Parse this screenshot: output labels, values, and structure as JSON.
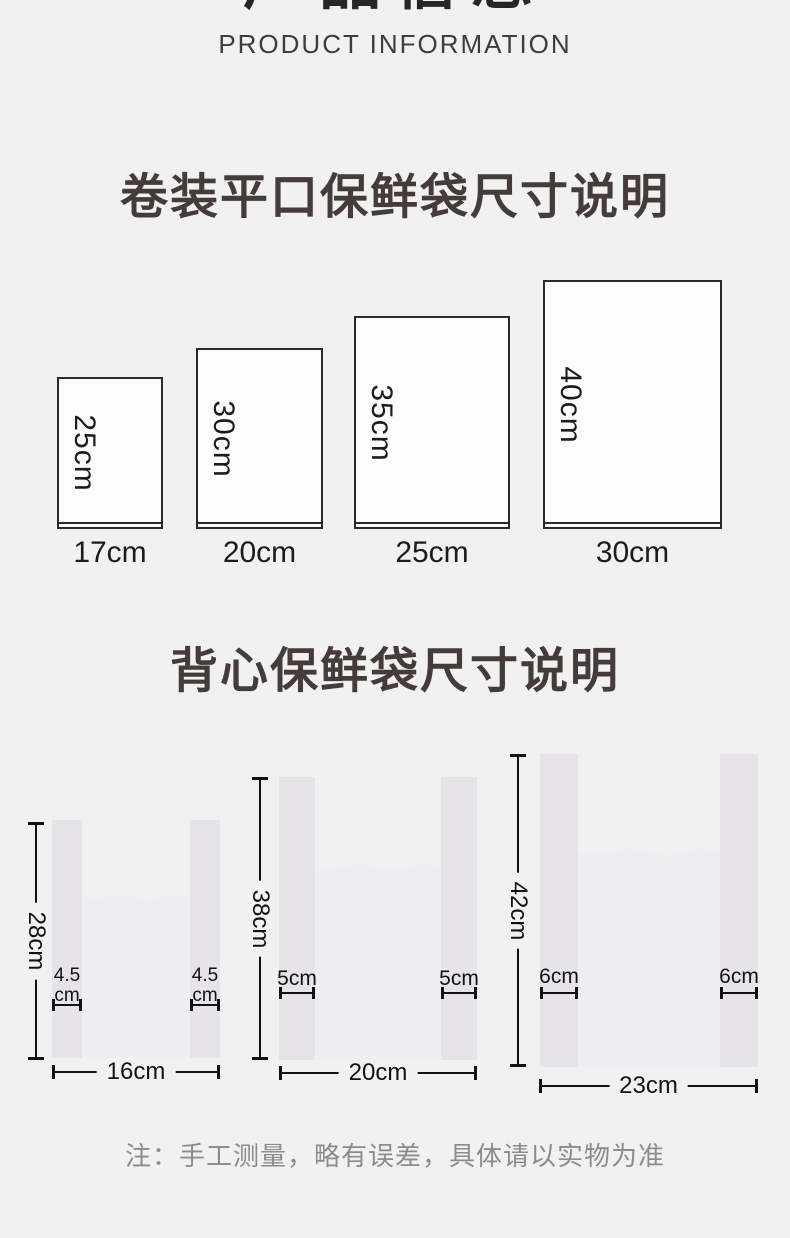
{
  "header": {
    "title_cn": "产品信息",
    "title_en": "PRODUCT INFORMATION"
  },
  "flat_section": {
    "title": "卷装平口保鲜袋尺寸说明",
    "bags": [
      {
        "height": "25cm",
        "width": "17cm"
      },
      {
        "height": "30cm",
        "width": "20cm"
      },
      {
        "height": "35cm",
        "width": "25cm"
      },
      {
        "height": "40cm",
        "width": "30cm"
      }
    ]
  },
  "vest_section": {
    "title": "背心保鲜袋尺寸说明",
    "bags": [
      {
        "height": "28cm",
        "width": "16cm",
        "handle_value": "4.5",
        "handle_unit": "cm"
      },
      {
        "height": "38cm",
        "width": "20cm",
        "handle_value": "5cm",
        "handle_unit": ""
      },
      {
        "height": "42cm",
        "width": "23cm",
        "handle_value": "6cm",
        "handle_unit": ""
      }
    ]
  },
  "note": "注：手工测量，略有误差，具体请以实物为准",
  "colors": {
    "background": "#f2f1f1",
    "title_dark": "#262626",
    "subtitle_gray": "#3d3d3d",
    "section_title": "#453b38",
    "dimension": "#121212",
    "rect_fill": "#fcfcfc",
    "handle_fill": "#e6e4e9",
    "body_fill": "#efeef3",
    "note_gray": "#8c8c8c"
  }
}
